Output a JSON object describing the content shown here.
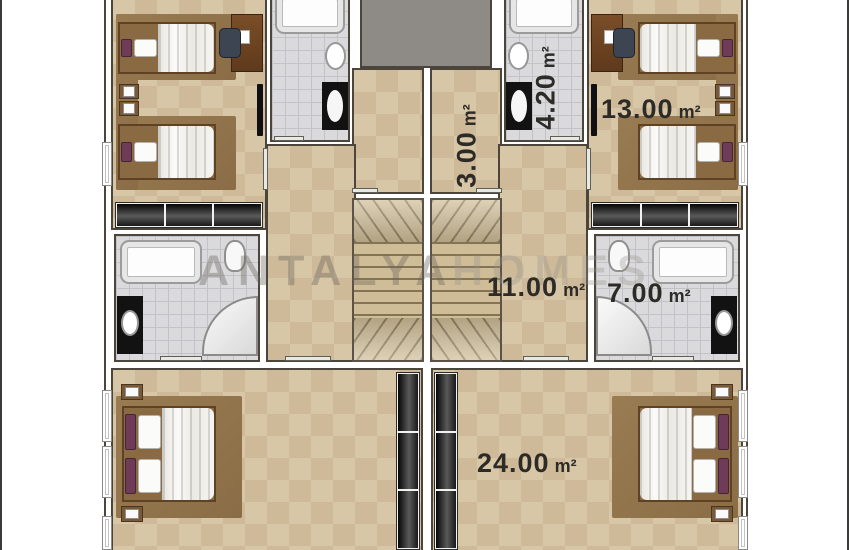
{
  "watermark": {
    "word1": "ANTALYA",
    "word2": "HOMES"
  },
  "labels": {
    "bedroom_top_right": {
      "value": "13.00",
      "unit": "m²"
    },
    "bathroom_top_right": {
      "value": "4.20",
      "unit": "m²"
    },
    "storage_right": {
      "value": "3.00",
      "unit": "m²"
    },
    "hall_right": {
      "value": "11.00",
      "unit": "m²"
    },
    "bathroom_mid_right": {
      "value": "7.00",
      "unit": "m²"
    },
    "bedroom_bottom_right": {
      "value": "24.00",
      "unit": "m²"
    }
  },
  "colors": {
    "floor_tan": "#d8c7a6",
    "tile_gray": "#dadadc",
    "wall_line": "#4b453c",
    "label_text": "#2d2b28",
    "carpet_brown": "#96784f",
    "wardrobe_dark": "#1c1c1e",
    "elevator_gray": "#8e8a86",
    "headboard_purple": "#6e3c57",
    "stair_tan": "#cfbd97"
  }
}
